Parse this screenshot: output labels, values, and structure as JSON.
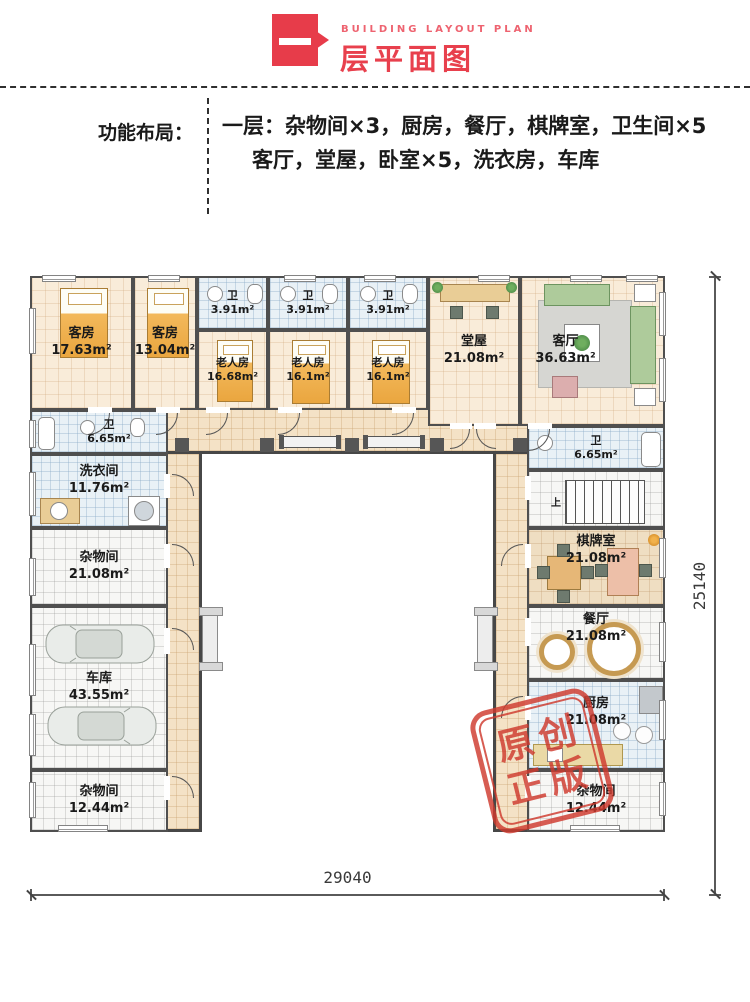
{
  "header": {
    "icon_text": "一",
    "subtitle": "BUILDING LAYOUT PLAN",
    "title": "层平面图"
  },
  "function_panel": {
    "label": "功能布局：",
    "line1": "一层：杂物间×3，厨房，餐厅，棋牌室，卫生间×5",
    "line2": "客厅，堂屋，卧室×5，洗衣房，车库"
  },
  "rooms": {
    "kefang1": {
      "name": "客房",
      "area": "17.63m²"
    },
    "kefang2": {
      "name": "客房",
      "area": "13.04m²"
    },
    "wc1": {
      "name": "卫",
      "area": "3.91m²"
    },
    "wc2": {
      "name": "卫",
      "area": "3.91m²"
    },
    "wc3": {
      "name": "卫",
      "area": "3.91m²"
    },
    "laoren1": {
      "name": "老人房",
      "area": "16.68m²"
    },
    "laoren2": {
      "name": "老人房",
      "area": "16.1m²"
    },
    "laoren3": {
      "name": "老人房",
      "area": "16.1m²"
    },
    "tangwu": {
      "name": "堂屋",
      "area": "21.08m²"
    },
    "keting": {
      "name": "客厅",
      "area": "36.63m²"
    },
    "wcL": {
      "name": "卫",
      "area": "6.65m²"
    },
    "xiyijian": {
      "name": "洗衣间",
      "area": "11.76m²"
    },
    "zawu1": {
      "name": "杂物间",
      "area": "21.08m²"
    },
    "cheku": {
      "name": "车库",
      "area": "43.55m²"
    },
    "zawu2": {
      "name": "杂物间",
      "area": "12.44m²"
    },
    "wcR": {
      "name": "卫",
      "area": "6.65m²"
    },
    "qipai": {
      "name": "棋牌室",
      "area": "21.08m²"
    },
    "canting": {
      "name": "餐厅",
      "area": "21.08m²"
    },
    "chufang": {
      "name": "厨房",
      "area": "21.08m²"
    },
    "zawu3": {
      "name": "杂物间",
      "area": "12.44m²"
    }
  },
  "stairs": {
    "up_label": "上"
  },
  "dimensions": {
    "width": "29040",
    "height": "25140"
  },
  "stamp": {
    "row1": "原创",
    "row2": "正版"
  }
}
